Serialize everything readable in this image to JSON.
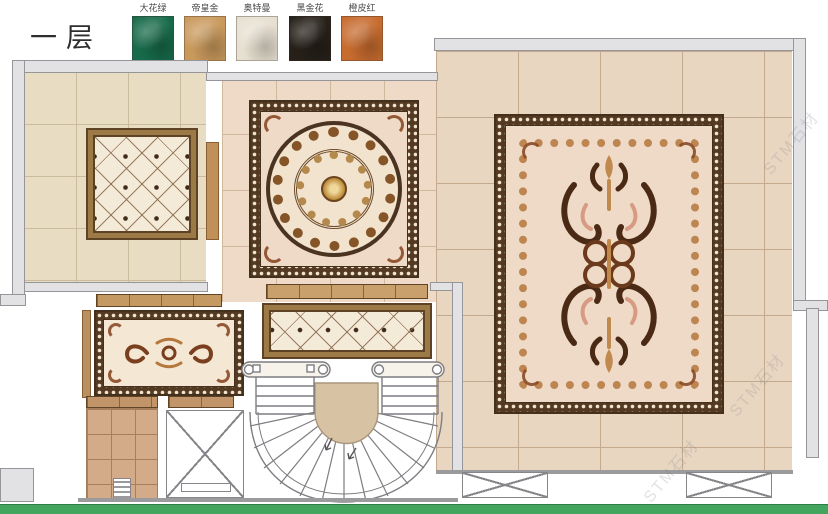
{
  "title": "一层",
  "legend": {
    "items": [
      {
        "label": "大花绿",
        "color": "#176a4a"
      },
      {
        "label": "帝皇金",
        "color": "#c9995c"
      },
      {
        "label": "奥特曼",
        "color": "#e7e0d1"
      },
      {
        "label": "黑金花",
        "color": "#262019"
      },
      {
        "label": "橙皮红",
        "color": "#c76b2e"
      }
    ]
  },
  "watermark": {
    "text": "STM石材"
  },
  "colors": {
    "accent_green": "#44a55e",
    "wall_gray": "#e2e2e5",
    "frame_gold": "#9c7a46",
    "frame_dark_brown": "#5d4226",
    "field_cream": "#f2e3cf"
  }
}
